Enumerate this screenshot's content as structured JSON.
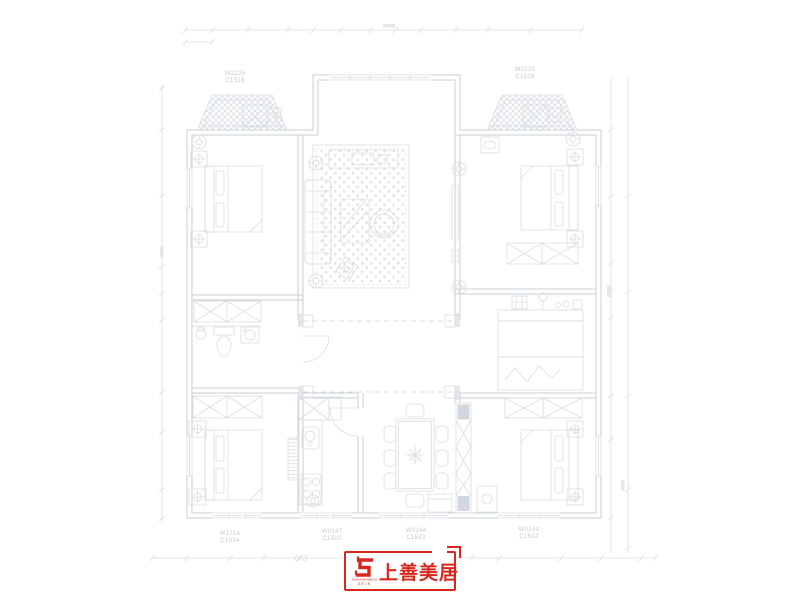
{
  "canvas": {
    "width": 800,
    "height": 600,
    "background": "#ffffff"
  },
  "drawing": {
    "kind": "residential-floor-plan-furniture-layout",
    "line_color": "#d9dde2",
    "wall_color": "#c9cfd6",
    "rug_dot_color": "#cdd3da",
    "window_labels": [
      {
        "id": "top-left-bay",
        "text1": "W2225",
        "text2": "C1518"
      },
      {
        "id": "top-right-bay",
        "text1": "W2225",
        "text2": "C1518"
      },
      {
        "id": "bottom-left",
        "text1": "W1714",
        "text2": "C1514"
      },
      {
        "id": "bottom-kitchen",
        "text1": "W0147",
        "text2": "C1502"
      },
      {
        "id": "bottom-dining",
        "text1": "W0144",
        "text2": "C1543"
      },
      {
        "id": "bottom-right",
        "text1": "W0143",
        "text2": "C1502"
      }
    ]
  },
  "logo": {
    "brand": "上善美居",
    "latin": "SHANGSHANMEIJU",
    "caption": "装 饰 工 程",
    "color": "#d8281e"
  }
}
